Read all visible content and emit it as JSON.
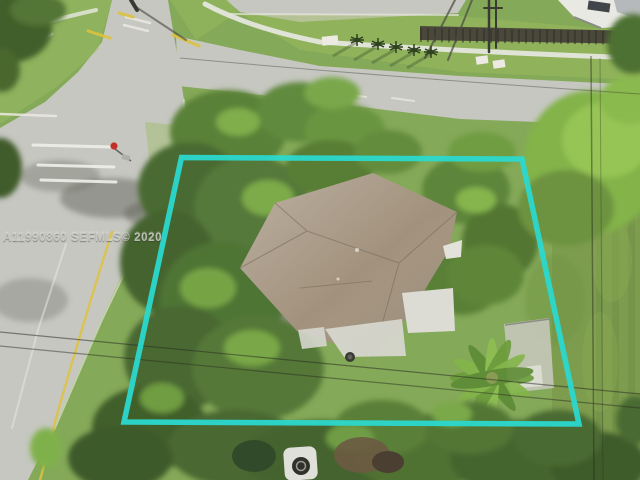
{
  "watermark": {
    "text": "A11990860 SEFMLS© 2020"
  },
  "overlay": {
    "boundary_color": "#2bd8cd"
  },
  "scene": {
    "colors": {
      "grass": "#84a958",
      "backyard_grass": "#7d9c4e",
      "road": "#c6c7c1",
      "canopy_dark": "#44632f",
      "canopy_bright": "#8ab747",
      "roof": "#a2927d",
      "concrete": "#dcdcd4",
      "asphalt": "#4e4f48",
      "stop_sign": "#c23128",
      "curb_yellow": "#dec23f",
      "marking_white": "#f0f0ea"
    }
  }
}
